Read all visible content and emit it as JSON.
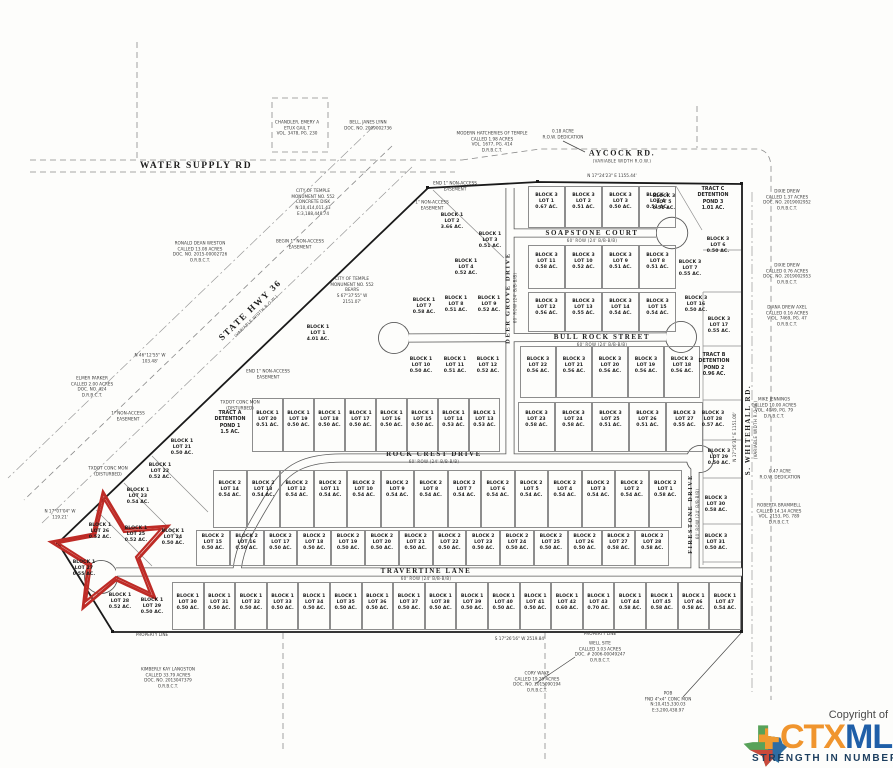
{
  "map": {
    "streets": [
      {
        "label": "WATER SUPPLY RD",
        "sub": ""
      },
      {
        "label": "AYCOCK RD.",
        "sub": "(VARIABLE WIDTH R.O.W.)"
      },
      {
        "label": "STATE HWY 36",
        "sub": "(VARIABLE WIDTH R.O.W.)"
      },
      {
        "label": "SOAPSTONE COURT",
        "sub": "60' ROW (24' B/B-B/B)"
      },
      {
        "label": "BULL ROCK STREET",
        "sub": "60' ROW (24' B/B-B/B)"
      },
      {
        "label": "ROCK CREST DRIVE",
        "sub": "60' ROW (24' B/B-B/B)"
      },
      {
        "label": "TRAVERTINE LANE",
        "sub": "60' ROW (24' B/B-B/B)"
      },
      {
        "label": "DEER GROVE DRIVE",
        "sub": "60' ROW (24' B/B-B/B)"
      },
      {
        "label": "FIRESTONE DRIVE",
        "sub": "60' ROW (24' B/B-B/B)"
      },
      {
        "label": "S. WHITEHALL RD.",
        "sub": "(VARIABLE WIDTH R.O.W.)"
      }
    ],
    "lot_rows": [
      {
        "y": 186,
        "h": 42,
        "label_y": 202,
        "x0": 528,
        "pitch": 37,
        "cells": [
          {
            "b": 3,
            "l": 1,
            "ac": "0.67"
          },
          {
            "b": 3,
            "l": 2,
            "ac": "0.51"
          },
          {
            "b": 3,
            "l": 3,
            "ac": "0.50"
          },
          {
            "b": 3,
            "l": 4,
            "ac": "0.51"
          }
        ]
      },
      {
        "y": 245,
        "h": 44,
        "label_y": 262,
        "x0": 528,
        "pitch": 37,
        "cells": [
          {
            "b": 3,
            "l": 11,
            "ac": "0.58"
          },
          {
            "b": 3,
            "l": 10,
            "ac": "0.52"
          },
          {
            "b": 3,
            "l": 9,
            "ac": "0.51"
          },
          {
            "b": 3,
            "l": 8,
            "ac": "0.51"
          }
        ]
      },
      {
        "y": 292,
        "h": 40,
        "label_y": 308,
        "x0": 528,
        "pitch": 37,
        "cells": [
          {
            "b": 3,
            "l": 12,
            "ac": "0.56"
          },
          {
            "b": 3,
            "l": 13,
            "ac": "0.55"
          },
          {
            "b": 3,
            "l": 14,
            "ac": "0.54"
          },
          {
            "b": 3,
            "l": 15,
            "ac": "0.54"
          }
        ]
      },
      {
        "y": 346,
        "h": 52,
        "label_y": 366,
        "x0": 520,
        "pitch": 36,
        "cells": [
          {
            "b": 3,
            "l": 22,
            "ac": "0.56"
          },
          {
            "b": 3,
            "l": 21,
            "ac": "0.56"
          },
          {
            "b": 3,
            "l": 20,
            "ac": "0.56"
          },
          {
            "b": 3,
            "l": 19,
            "ac": "0.56"
          },
          {
            "b": 3,
            "l": 18,
            "ac": "0.56"
          }
        ]
      },
      {
        "y": 402,
        "h": 50,
        "label_y": 420,
        "x0": 518,
        "pitch": 37,
        "cells": [
          {
            "b": 3,
            "l": 23,
            "ac": "0.58"
          },
          {
            "b": 3,
            "l": 24,
            "ac": "0.58"
          },
          {
            "b": 3,
            "l": 25,
            "ac": "0.51"
          },
          {
            "b": 3,
            "l": 26,
            "ac": "0.51"
          },
          {
            "b": 3,
            "l": 27,
            "ac": "0.55"
          }
        ]
      },
      {
        "y": 470,
        "h": 58,
        "label_y": 490,
        "x0": 213,
        "pitch": 33.5,
        "cells": [
          {
            "b": 2,
            "l": 14,
            "ac": "0.54"
          },
          {
            "b": 2,
            "l": 13,
            "ac": "0.54"
          },
          {
            "b": 2,
            "l": 12,
            "ac": "0.54"
          },
          {
            "b": 2,
            "l": 11,
            "ac": "0.54"
          },
          {
            "b": 2,
            "l": 10,
            "ac": "0.54"
          },
          {
            "b": 2,
            "l": 9,
            "ac": "0.54"
          },
          {
            "b": 2,
            "l": 8,
            "ac": "0.54"
          },
          {
            "b": 2,
            "l": 7,
            "ac": "0.54"
          },
          {
            "b": 2,
            "l": 6,
            "ac": "0.54"
          },
          {
            "b": 2,
            "l": 5,
            "ac": "0.54"
          },
          {
            "b": 2,
            "l": 4,
            "ac": "0.54"
          },
          {
            "b": 2,
            "l": 3,
            "ac": "0.54"
          },
          {
            "b": 2,
            "l": 2,
            "ac": "0.54"
          },
          {
            "b": 2,
            "l": 1,
            "ac": "0.58"
          }
        ]
      },
      {
        "y": 530,
        "h": 36,
        "label_y": 543,
        "x0": 196,
        "pitch": 33.8,
        "cells": [
          {
            "b": 2,
            "l": 15,
            "ac": "0.50"
          },
          {
            "b": 2,
            "l": 16,
            "ac": "0.50"
          },
          {
            "b": 2,
            "l": 17,
            "ac": "0.50"
          },
          {
            "b": 2,
            "l": 18,
            "ac": "0.50"
          },
          {
            "b": 2,
            "l": 19,
            "ac": "0.50"
          },
          {
            "b": 2,
            "l": 20,
            "ac": "0.50"
          },
          {
            "b": 2,
            "l": 21,
            "ac": "0.50"
          },
          {
            "b": 2,
            "l": 22,
            "ac": "0.50"
          },
          {
            "b": 2,
            "l": 23,
            "ac": "0.50"
          },
          {
            "b": 2,
            "l": 24,
            "ac": "0.50"
          },
          {
            "b": 2,
            "l": 25,
            "ac": "0.50"
          },
          {
            "b": 2,
            "l": 26,
            "ac": "0.50"
          },
          {
            "b": 2,
            "l": 27,
            "ac": "0.58"
          },
          {
            "b": 2,
            "l": 28,
            "ac": "0.58"
          }
        ]
      },
      {
        "y": 582,
        "h": 48,
        "label_y": 603,
        "x0": 172,
        "pitch": 31.6,
        "cells": [
          {
            "b": 1,
            "l": 30,
            "ac": "0.50"
          },
          {
            "b": 1,
            "l": 31,
            "ac": "0.50"
          },
          {
            "b": 1,
            "l": 32,
            "ac": "0.50"
          },
          {
            "b": 1,
            "l": 33,
            "ac": "0.50"
          },
          {
            "b": 1,
            "l": 34,
            "ac": "0.50"
          },
          {
            "b": 1,
            "l": 35,
            "ac": "0.50"
          },
          {
            "b": 1,
            "l": 36,
            "ac": "0.50"
          },
          {
            "b": 1,
            "l": 37,
            "ac": "0.50"
          },
          {
            "b": 1,
            "l": 38,
            "ac": "0.50"
          },
          {
            "b": 1,
            "l": 39,
            "ac": "0.50"
          },
          {
            "b": 1,
            "l": 40,
            "ac": "0.50"
          },
          {
            "b": 1,
            "l": 41,
            "ac": "0.50"
          },
          {
            "b": 1,
            "l": 42,
            "ac": "0.60"
          },
          {
            "b": 1,
            "l": 43,
            "ac": "0.70"
          },
          {
            "b": 1,
            "l": 44,
            "ac": "0.58"
          },
          {
            "b": 1,
            "l": 45,
            "ac": "0.58"
          },
          {
            "b": 1,
            "l": 46,
            "ac": "0.58"
          },
          {
            "b": 1,
            "l": 47,
            "ac": "0.54"
          }
        ]
      },
      {
        "y": 398,
        "h": 54,
        "label_y": 420,
        "x0": 252,
        "pitch": 31,
        "cells": [
          {
            "b": 1,
            "l": 20,
            "ac": "0.51"
          },
          {
            "b": 1,
            "l": 19,
            "ac": "0.50"
          },
          {
            "b": 1,
            "l": 18,
            "ac": "0.50"
          },
          {
            "b": 1,
            "l": 17,
            "ac": "0.50"
          },
          {
            "b": 1,
            "l": 16,
            "ac": "0.50"
          },
          {
            "b": 1,
            "l": 15,
            "ac": "0.50"
          },
          {
            "b": 1,
            "l": 14,
            "ac": "0.53"
          },
          {
            "b": 1,
            "l": 13,
            "ac": "0.53"
          }
        ]
      }
    ],
    "lots_free": [
      {
        "x": 318,
        "y": 334,
        "b": 1,
        "l": 1,
        "ac": "4.01"
      },
      {
        "x": 452,
        "y": 222,
        "b": 1,
        "l": 2,
        "ac": "3.66"
      },
      {
        "x": 490,
        "y": 241,
        "b": 1,
        "l": 3,
        "ac": "0.51"
      },
      {
        "x": 466,
        "y": 268,
        "b": 1,
        "l": 4,
        "ac": "0.52"
      },
      {
        "x": 424,
        "y": 307,
        "b": 1,
        "l": 7,
        "ac": "0.58"
      },
      {
        "x": 456,
        "y": 305,
        "b": 1,
        "l": 8,
        "ac": "0.51"
      },
      {
        "x": 489,
        "y": 305,
        "b": 1,
        "l": 9,
        "ac": "0.52"
      },
      {
        "x": 421,
        "y": 366,
        "b": 1,
        "l": 10,
        "ac": "0.50"
      },
      {
        "x": 455,
        "y": 366,
        "b": 1,
        "l": 11,
        "ac": "0.51"
      },
      {
        "x": 488,
        "y": 366,
        "b": 1,
        "l": 12,
        "ac": "0.52"
      },
      {
        "x": 664,
        "y": 203,
        "b": 3,
        "l": 5,
        "ac": "0.51"
      },
      {
        "x": 718,
        "y": 246,
        "b": 3,
        "l": 6,
        "ac": "0.50"
      },
      {
        "x": 690,
        "y": 269,
        "b": 3,
        "l": 7,
        "ac": "0.55"
      },
      {
        "x": 696,
        "y": 305,
        "b": 3,
        "l": 16,
        "ac": "0.50"
      },
      {
        "x": 719,
        "y": 326,
        "b": 3,
        "l": 17,
        "ac": "0.55"
      },
      {
        "x": 713,
        "y": 420,
        "b": 3,
        "l": 28,
        "ac": "0.57"
      },
      {
        "x": 719,
        "y": 458,
        "b": 3,
        "l": 29,
        "ac": "0.50"
      },
      {
        "x": 716,
        "y": 505,
        "b": 3,
        "l": 30,
        "ac": "0.58"
      },
      {
        "x": 716,
        "y": 543,
        "b": 3,
        "l": 31,
        "ac": "0.50"
      },
      {
        "x": 182,
        "y": 448,
        "b": 1,
        "l": 21,
        "ac": "0.50"
      },
      {
        "x": 160,
        "y": 472,
        "b": 1,
        "l": 22,
        "ac": "0.52"
      },
      {
        "x": 138,
        "y": 497,
        "b": 1,
        "l": 23,
        "ac": "0.54"
      },
      {
        "x": 173,
        "y": 538,
        "b": 1,
        "l": 24,
        "ac": "0.50"
      },
      {
        "x": 136,
        "y": 535,
        "b": 1,
        "l": 25,
        "ac": "0.52"
      },
      {
        "x": 100,
        "y": 532,
        "b": 1,
        "l": 26,
        "ac": "0.52"
      },
      {
        "x": 84,
        "y": 569,
        "b": 1,
        "l": 27,
        "ac": "0.55"
      },
      {
        "x": 120,
        "y": 602,
        "b": 1,
        "l": 28,
        "ac": "0.52"
      },
      {
        "x": 152,
        "y": 607,
        "b": 1,
        "l": 29,
        "ac": "0.50"
      }
    ],
    "notes": [
      {
        "x": 313,
        "y": 202,
        "t": "CITY OF TEMPLE\nMONUMENT NO. 552\nCONCRETE DISK\nN:10,414,011.43\nE:3,188,448.74"
      },
      {
        "x": 352,
        "y": 290,
        "t": "CITY OF TEMPLE\nMONUMENT NO. 552\nBEARS\nS 67°37'55\" W\n2151.07'"
      },
      {
        "x": 300,
        "y": 244,
        "t": "BEGIN 1\" NON-ACCESS\nEASEMENT"
      },
      {
        "x": 455,
        "y": 186,
        "t": "END 1\" NON-ACCESS\nEASEMENT"
      },
      {
        "x": 432,
        "y": 205,
        "t": "1\" NON-ACCESS\nEASEMENT"
      },
      {
        "x": 268,
        "y": 374,
        "t": "END 1\" NON-ACCESS\nEASEMENT"
      },
      {
        "x": 128,
        "y": 416,
        "t": "1\" NON-ACCESS\nEASEMENT"
      },
      {
        "x": 150,
        "y": 358,
        "t": "N 46°12'55\" W\n103.48'"
      },
      {
        "x": 60,
        "y": 514,
        "t": "N 17°07'04\" W\n119.21'"
      },
      {
        "x": 108,
        "y": 471,
        "t": "TXDOT CONC MON\n(DISTURBED)"
      },
      {
        "x": 240,
        "y": 405,
        "t": "TXDOT CONC MON\n(DISTURBED)"
      },
      {
        "x": 563,
        "y": 134,
        "t": "0.18 ACRE\nR.O.W. DEDICATION"
      },
      {
        "x": 612,
        "y": 176,
        "t": "N 17°24'23\" E   1155.44'"
      },
      {
        "x": 787,
        "y": 200,
        "t": "DIXIE DREW\nCALLED 1.37 ACRES\nDOC. NO. 2019002952\nO.R.B.C.T."
      },
      {
        "x": 787,
        "y": 274,
        "t": "DIXIE DREW\nCALLED 0.76 ACRES\nDOC. NO. 2019002953\nO.R.B.C.T."
      },
      {
        "x": 787,
        "y": 316,
        "t": "DIANA DREW AXEL\nCALLED 0.16 ACRES\nV OL. 7469, PG. 47\nO.R.B.C.T."
      },
      {
        "x": 774,
        "y": 408,
        "t": "MIKE JENNINGS\nCALLED 10.00 ACRES\nVOL. 4049, PG. 79\nD.R.B.C.T."
      },
      {
        "x": 780,
        "y": 474,
        "t": "0.47 ACRE\nR.O.W. DEDICATION"
      },
      {
        "x": 779,
        "y": 514,
        "t": "ROBERTA BRAMMELL\nCALLED 14.14 ACRES\nVOL. 2153, PG. 789\nD.R.B.C.T."
      },
      {
        "x": 735,
        "y": 437,
        "r": -90,
        "t": "N 17°26'31\" E   1151.00'"
      },
      {
        "x": 520,
        "y": 639,
        "t": "S 17°26'16\" W   2519.84'"
      },
      {
        "x": 152,
        "y": 635,
        "t": "PROPERTY LINE"
      },
      {
        "x": 600,
        "y": 634,
        "t": "PROPERTY LINE"
      },
      {
        "x": 168,
        "y": 678,
        "t": "KIMBERLY KAY LANGSTON\nCALLED 33.79 ACRES\nDOC. NO. 2013047379\nO.R.B.C.T."
      },
      {
        "x": 537,
        "y": 682,
        "t": "CORY WAKE\nCALLED 19.29 ACRES\nDOC. NO. 2015090194\nO.R.B.C.T."
      },
      {
        "x": 600,
        "y": 652,
        "t": "WELL SITE\nCALLED 3.03 ACRES\nDOC. # 2006-00049247\nO.R.B.C.T."
      },
      {
        "x": 668,
        "y": 702,
        "t": "POB\nFND 4\"x4\" CONC MON\nN:10,415,330.03\nE:3,200,438.97"
      },
      {
        "x": 297,
        "y": 128,
        "t": "CHANDLER, EMERY A\nETUX GAIL T\nVOL. 3478, PG. 230"
      },
      {
        "x": 368,
        "y": 125,
        "t": "BELL, JANES LYNN\nDOC. NO. 2009002736"
      },
      {
        "x": 492,
        "y": 142,
        "t": "MODERN HATCHERIES OF TEMPLE\nCALLED 1.98 ACRES\nVOL. 1677, PG. 414\nD.R.B.C.T."
      },
      {
        "x": 200,
        "y": 252,
        "t": "RONALD DEAN WESTON\nCALLED 13.08 ACRES\nDOC. NO. 2015-00002726\nO.R.B.C.T."
      },
      {
        "x": 92,
        "y": 387,
        "t": "ELMER PARKER\nCALLED 2.00 ACRES\nDOC. NO. 424\nD.R.B.C.T."
      },
      {
        "x": 230,
        "y": 424,
        "c": "tract",
        "t": "TRACT A\nDETENTION\nPOND 1\n1.5 AC."
      },
      {
        "x": 714,
        "y": 366,
        "c": "tract",
        "t": "TRACT B\nDETENTION\nPOND 2\n0.96 AC."
      },
      {
        "x": 713,
        "y": 200,
        "c": "tract",
        "t": "TRACT C\nDETENTION\nPOND 3\n1.01 AC."
      }
    ]
  },
  "highlight": {
    "starred_lot": "BLOCK 1 LOT 26 0.52 AC.",
    "star_color": "#BE2B26"
  },
  "watermark": {
    "copyright": "Copyright of",
    "brand_ctx": "CTX",
    "brand_mls": "MLS",
    "tagline": "STRENGTH IN NUMBERS",
    "colors": {
      "ctx": "#F0952E",
      "mls": "#1F5FA8",
      "tagline": "#1C3E5E",
      "copyright": "#4A4A4A",
      "texas_green": "#58A259",
      "texas_blue": "#2E6DA4",
      "texas_red": "#C9493B",
      "texas_orange": "#F09A30"
    }
  }
}
